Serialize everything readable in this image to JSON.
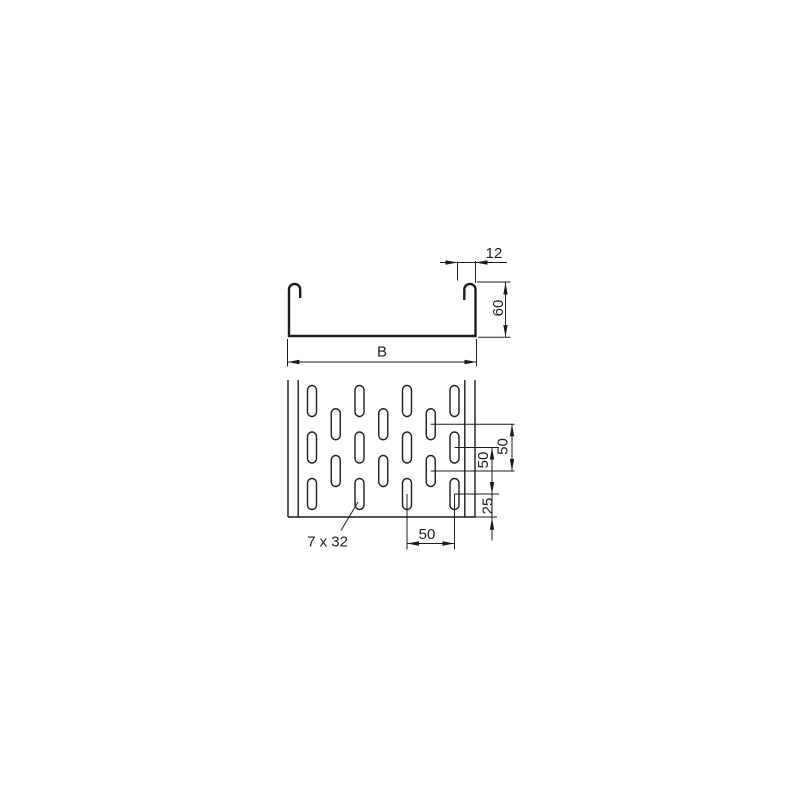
{
  "drawing": {
    "description": "cable-tray technical drawing with cross-section and perforation plan view",
    "colors": {
      "line": "#1c1c1c",
      "background": "#ffffff"
    },
    "cross_section": {
      "flange_width_label": "12",
      "side_height_label": "60",
      "base_width_label": "B"
    },
    "plan_view": {
      "row_pitch_outer_label": "50",
      "row_pitch_inner_label": "50",
      "row_offset_label": "25",
      "column_pitch_label": "50",
      "slot_size_label": "7 x 32"
    }
  }
}
